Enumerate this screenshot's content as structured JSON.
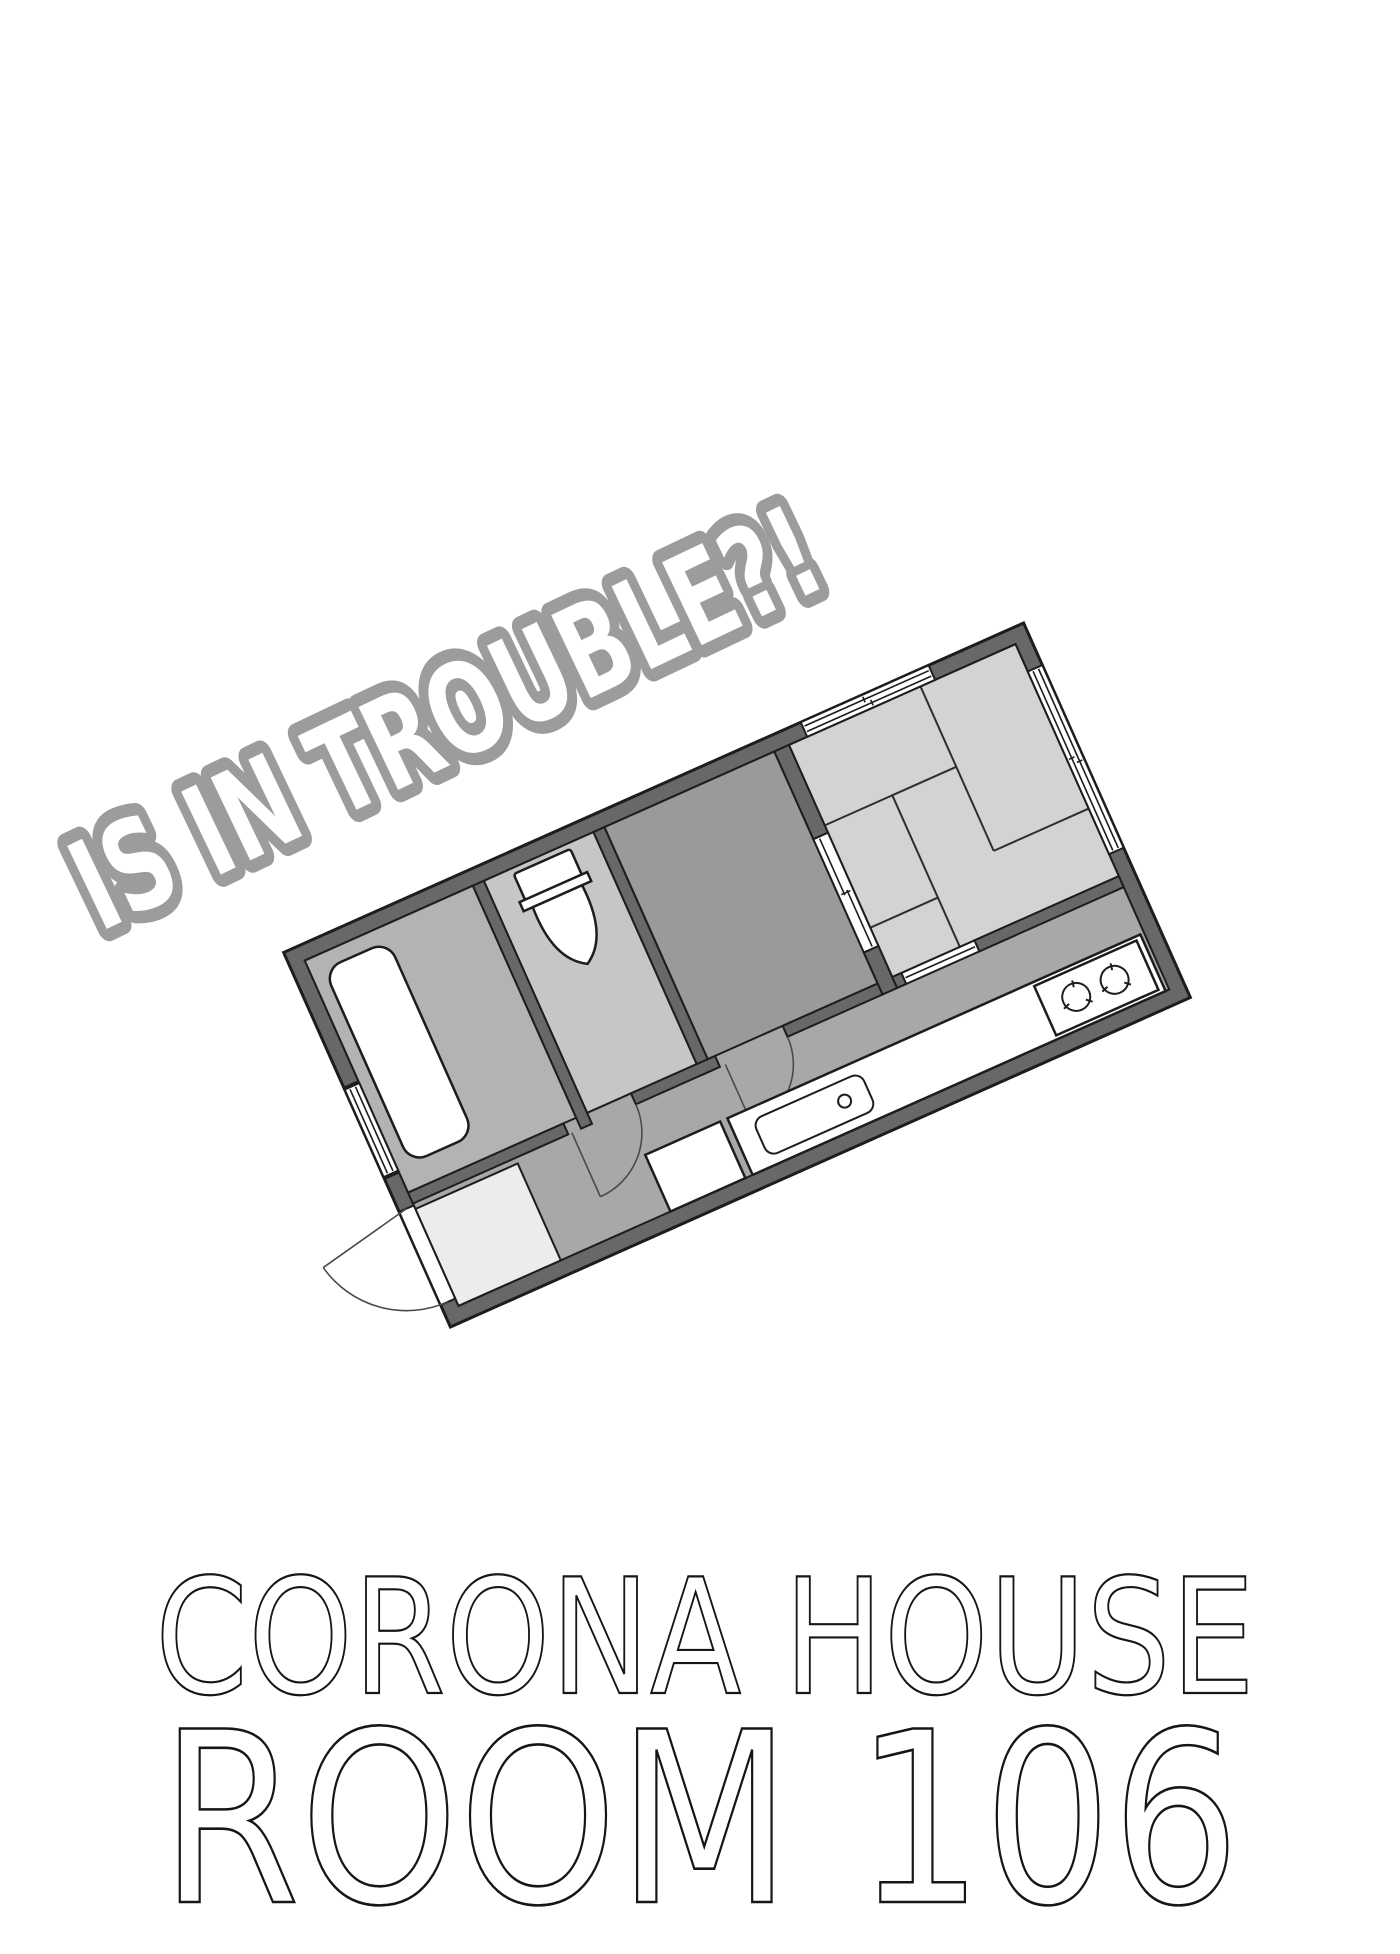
{
  "page": {
    "width_px": 1400,
    "height_px": 1954,
    "background": "#ffffff"
  },
  "headline": {
    "text": "IS IN TROUBLE?!",
    "style": "comic-bubble-outline",
    "fill_color": "#ffffff",
    "outline_color": "#9c9c9c",
    "rotation_deg": -25.5
  },
  "floor_plan": {
    "type": "apartment-room-floor-plan",
    "rotation_deg": -24,
    "colors": {
      "wall_fill": "#686868",
      "line": "#1d1d1d",
      "hall_kitchen_floor": "#a8a8a8",
      "bathroom_floor": "#b3b3b3",
      "toilet_room_floor": "#c6c6c6",
      "dark_room_floor": "#9a9a9a",
      "tatami_room_floor": "#d3d3d3",
      "entrance_floor": "#ececec",
      "fixture_fill": "#ffffff"
    },
    "rooms": [
      "bathroom",
      "toilet-room",
      "utility-room",
      "tatami-room",
      "kitchen-hall",
      "entrance-genkan"
    ],
    "fixtures": [
      "bathtub",
      "toilet",
      "kitchen-sink",
      "gas-stove-2-burner",
      "washer-space",
      "entrance-swing-door",
      "interior-swing-doors",
      "sliding-doors",
      "windows"
    ]
  },
  "footer": {
    "building_name": "CORONA HOUSE",
    "room_number": "ROOM 106",
    "text_color": "#161616"
  }
}
